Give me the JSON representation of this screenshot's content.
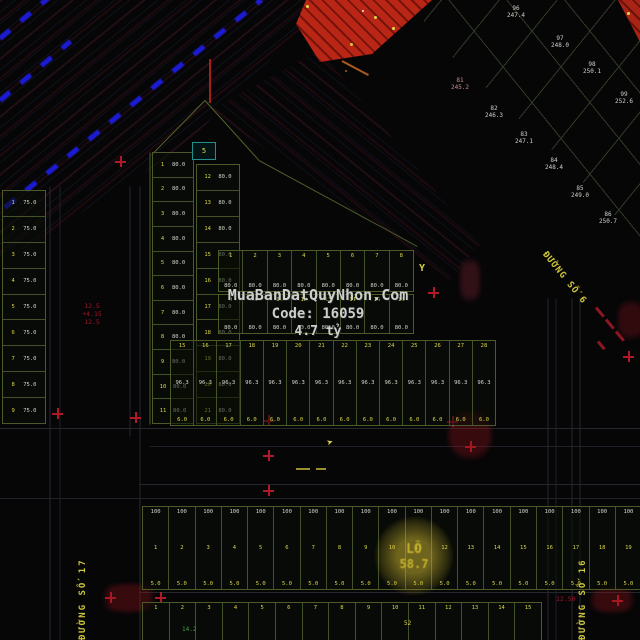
{
  "watermark": {
    "line1": "MuaBanDatQuyNhon.Com",
    "line2": "Code: 16059",
    "line3": "4.7 tỷ"
  },
  "streets": {
    "right_diagonal": "ĐƯỜNG SỐ 6",
    "left_vertical": "ĐƯỜNG SỐ 17",
    "right_vertical": "ĐƯỜNG SỐ 16"
  },
  "markers": {
    "y_mark": "Y",
    "plane_glyph": "➤",
    "stamp_line1": "LÔ",
    "stamp_line2": "58.7",
    "teal_box_label": "5",
    "road_annotation": [
      "12.5",
      "+4.15",
      "12.5"
    ],
    "south_road_annotation": "12.50",
    "bottom_green_note": "14.2",
    "bottom_yellow_note": "52"
  },
  "colors": {
    "background": "#060607",
    "blue_dash": "#1b1bd6",
    "red_fill": "#b92616",
    "parcel_border": "#4c5a28",
    "yellow_text": "#ddd74a",
    "white_text": "#d6d8ce",
    "red_annotation": "#a51628",
    "street_yellow": "#cfc53a"
  },
  "grid_labels": [
    {
      "x": 516,
      "y": 6,
      "l1": "96",
      "l2": "247.4",
      "pink": false
    },
    {
      "x": 560,
      "y": 36,
      "l1": "97",
      "l2": "248.0",
      "pink": false
    },
    {
      "x": 592,
      "y": 62,
      "l1": "98",
      "l2": "250.1",
      "pink": false
    },
    {
      "x": 624,
      "y": 92,
      "l1": "99",
      "l2": "252.6",
      "pink": false
    },
    {
      "x": 460,
      "y": 78,
      "l1": "81",
      "l2": "245.2",
      "pink": true
    },
    {
      "x": 494,
      "y": 106,
      "l1": "82",
      "l2": "246.3",
      "pink": false
    },
    {
      "x": 524,
      "y": 132,
      "l1": "83",
      "l2": "247.1",
      "pink": false
    },
    {
      "x": 554,
      "y": 158,
      "l1": "84",
      "l2": "248.4",
      "pink": false
    },
    {
      "x": 580,
      "y": 186,
      "l1": "85",
      "l2": "249.0",
      "pink": false
    },
    {
      "x": 608,
      "y": 212,
      "l1": "86",
      "l2": "250.7",
      "pink": false
    }
  ],
  "strips": [
    {
      "id": "left-strip",
      "x": 2,
      "y": 190,
      "w": 42,
      "h": 232,
      "dir": "rows",
      "slots": [
        "yl",
        "wh"
      ],
      "cells": [
        [
          "1",
          "75.0"
        ],
        [
          "2",
          "75.0"
        ],
        [
          "3",
          "75.0"
        ],
        [
          "4",
          "75.0"
        ],
        [
          "5",
          "75.0"
        ],
        [
          "6",
          "75.0"
        ],
        [
          "7",
          "75.0"
        ],
        [
          "8",
          "75.0"
        ],
        [
          "9",
          "75.0"
        ]
      ]
    },
    {
      "id": "col-a",
      "x": 152,
      "y": 152,
      "w": 40,
      "h": 270,
      "dir": "rows",
      "slots": [
        "yl",
        "wh"
      ],
      "cells": [
        [
          "1",
          "80.0"
        ],
        [
          "2",
          "80.0"
        ],
        [
          "3",
          "80.0"
        ],
        [
          "4",
          "80.0"
        ],
        [
          "5",
          "80.0"
        ],
        [
          "6",
          "80.0"
        ],
        [
          "7",
          "80.0"
        ],
        [
          "8",
          "80.0"
        ],
        [
          "9",
          "80.0"
        ],
        [
          "10",
          "80.0"
        ],
        [
          "11",
          "80.0"
        ]
      ]
    },
    {
      "id": "col-b",
      "x": 196,
      "y": 164,
      "w": 42,
      "h": 258,
      "dir": "rows",
      "slots": [
        "yl",
        "wh"
      ],
      "cells": [
        [
          "12",
          "80.0"
        ],
        [
          "13",
          "80.0"
        ],
        [
          "14",
          "80.0"
        ],
        [
          "15",
          "80.0"
        ],
        [
          "16",
          "80.0"
        ],
        [
          "17",
          "80.0"
        ],
        [
          "18",
          "80.0"
        ],
        [
          "19",
          "80.0"
        ],
        [
          "20",
          "80.0"
        ],
        [
          "21",
          "80.0"
        ]
      ]
    },
    {
      "id": "band-top",
      "x": 218,
      "y": 250,
      "w": 194,
      "h": 40,
      "dir": "cols",
      "slots": [
        "yl",
        "wh"
      ],
      "cells": [
        [
          "1",
          "80.0"
        ],
        [
          "2",
          "80.0"
        ],
        [
          "3",
          "80.0"
        ],
        [
          "4",
          "80.0"
        ],
        [
          "5",
          "80.0"
        ],
        [
          "6",
          "80.0"
        ],
        [
          "7",
          "80.0"
        ],
        [
          "8",
          "80.0"
        ]
      ]
    },
    {
      "id": "band-mid",
      "x": 218,
      "y": 294,
      "w": 194,
      "h": 38,
      "dir": "cols",
      "slots": [
        "yl",
        "wh"
      ],
      "cells": [
        [
          "9",
          "80.0"
        ],
        [
          "10",
          "80.0"
        ],
        [
          "11",
          "80.0"
        ],
        [
          "12",
          "80.0"
        ],
        [
          "13",
          "80.0"
        ],
        [
          "14",
          "80.0"
        ],
        [
          "15",
          "80.0"
        ],
        [
          "16",
          "80.0"
        ]
      ]
    },
    {
      "id": "band-bottom",
      "x": 170,
      "y": 340,
      "w": 324,
      "h": 84,
      "dir": "cols",
      "slots": [
        "yl",
        "wh",
        "yl"
      ],
      "cells": [
        [
          "15",
          "96.3",
          "6.0"
        ],
        [
          "16",
          "96.3",
          "6.0"
        ],
        [
          "17",
          "96.3",
          "6.0"
        ],
        [
          "18",
          "96.3",
          "6.0"
        ],
        [
          "19",
          "96.3",
          "6.0"
        ],
        [
          "20",
          "96.3",
          "6.0"
        ],
        [
          "21",
          "96.3",
          "6.0"
        ],
        [
          "22",
          "96.3",
          "6.0"
        ],
        [
          "23",
          "96.3",
          "6.0"
        ],
        [
          "24",
          "96.3",
          "6.0"
        ],
        [
          "25",
          "96.3",
          "6.0"
        ],
        [
          "26",
          "96.3",
          "6.0"
        ],
        [
          "27",
          "96.3",
          "6.0"
        ],
        [
          "28",
          "96.3",
          "6.0"
        ]
      ]
    },
    {
      "id": "strip-south",
      "x": 142,
      "y": 506,
      "w": 498,
      "h": 82,
      "dir": "cols",
      "slots": [
        "wh",
        "yl",
        "yl"
      ],
      "cells": [
        [
          "100",
          "1",
          "5.0"
        ],
        [
          "100",
          "2",
          "5.0"
        ],
        [
          "100",
          "3",
          "5.0"
        ],
        [
          "100",
          "4",
          "5.0"
        ],
        [
          "100",
          "5",
          "5.0"
        ],
        [
          "100",
          "6",
          "5.0"
        ],
        [
          "100",
          "7",
          "5.0"
        ],
        [
          "100",
          "8",
          "5.0"
        ],
        [
          "100",
          "9",
          "5.0"
        ],
        [
          "100",
          "10",
          "5.0"
        ],
        [
          "100",
          "11",
          "5.0"
        ],
        [
          "100",
          "12",
          "5.0"
        ],
        [
          "100",
          "13",
          "5.0"
        ],
        [
          "100",
          "14",
          "5.0"
        ],
        [
          "100",
          "15",
          "5.0"
        ],
        [
          "100",
          "16",
          "5.0"
        ],
        [
          "100",
          "17",
          "5.0"
        ],
        [
          "100",
          "18",
          "5.0"
        ],
        [
          "100",
          "19",
          "5.0"
        ]
      ]
    },
    {
      "id": "strip-south2",
      "x": 142,
      "y": 602,
      "w": 398,
      "h": 38,
      "dir": "cols",
      "slots": [
        "yl"
      ],
      "cells": [
        [
          "1"
        ],
        [
          "2"
        ],
        [
          "3"
        ],
        [
          "4"
        ],
        [
          "5"
        ],
        [
          "6"
        ],
        [
          "7"
        ],
        [
          "8"
        ],
        [
          "9"
        ],
        [
          "10"
        ],
        [
          "11"
        ],
        [
          "12"
        ],
        [
          "13"
        ],
        [
          "14"
        ],
        [
          "15"
        ]
      ]
    }
  ],
  "blue_dashes": [
    {
      "x": 5,
      "y": 205,
      "len": 330,
      "rot": -39
    },
    {
      "x": 0,
      "y": 98,
      "len": 92,
      "rot": -40
    },
    {
      "x": 0,
      "y": 36,
      "len": 64,
      "rot": -40
    }
  ],
  "lines": [
    {
      "x": 205,
      "y": 100,
      "len": 76,
      "rot": 134.5,
      "c": "#566628",
      "t": 1
    },
    {
      "x": 205,
      "y": 100,
      "len": 81,
      "rot": 48,
      "c": "#566628",
      "t": 1
    },
    {
      "x": 259,
      "y": 160,
      "len": 180,
      "rot": 28.5,
      "c": "#4c5a26",
      "t": 1
    },
    {
      "x": 150,
      "y": 152,
      "len": 272,
      "rot": 90,
      "c": "#4f5e2a",
      "t": 1
    },
    {
      "x": 0,
      "y": 428,
      "len": 640,
      "rot": 0,
      "c": "#26262e",
      "t": 1
    },
    {
      "x": 150,
      "y": 446,
      "len": 490,
      "rot": 0,
      "c": "#21212a",
      "t": 1
    },
    {
      "x": 140,
      "y": 484,
      "len": 500,
      "rot": 0,
      "c": "#26262e",
      "t": 1
    },
    {
      "x": 0,
      "y": 498,
      "len": 640,
      "rot": 0,
      "c": "#21212a",
      "t": 1
    },
    {
      "x": 140,
      "y": 592,
      "len": 500,
      "rot": 0,
      "c": "#26262e",
      "t": 1
    },
    {
      "x": 50,
      "y": 186,
      "len": 454,
      "rot": 90,
      "c": "#262630",
      "t": 1
    },
    {
      "x": 60,
      "y": 186,
      "len": 454,
      "rot": 90,
      "c": "#1f1f28",
      "t": 1
    },
    {
      "x": 130,
      "y": 186,
      "len": 250,
      "rot": 90,
      "c": "#262630",
      "t": 1
    },
    {
      "x": 140,
      "y": 186,
      "len": 454,
      "rot": 90,
      "c": "#262630",
      "t": 1
    },
    {
      "x": 548,
      "y": 298,
      "len": 342,
      "rot": 90,
      "c": "#262630",
      "t": 1
    },
    {
      "x": 556,
      "y": 298,
      "len": 342,
      "rot": 90,
      "c": "#1f1f28",
      "t": 1
    },
    {
      "x": 572,
      "y": 298,
      "len": 342,
      "rot": 90,
      "c": "#262630",
      "t": 1
    },
    {
      "x": 580,
      "y": 298,
      "len": 342,
      "rot": 90,
      "c": "#262630",
      "t": 1
    },
    {
      "x": 296,
      "y": 468,
      "len": 14,
      "rot": 0,
      "c": "#9a8f2e",
      "t": 2
    },
    {
      "x": 316,
      "y": 468,
      "len": 10,
      "rot": 0,
      "c": "#9a8f2e",
      "t": 2
    },
    {
      "x": 210,
      "y": 58,
      "len": 44,
      "rot": 90,
      "c": "#a32015",
      "t": 2
    },
    {
      "x": 342,
      "y": 60,
      "len": 30,
      "rot": 28,
      "c": "#a85a20",
      "t": 2
    },
    {
      "x": 596,
      "y": 306,
      "len": 12,
      "rot": 50,
      "c": "#8c1622",
      "t": 3
    },
    {
      "x": 606,
      "y": 318,
      "len": 12,
      "rot": 50,
      "c": "#8c1622",
      "t": 3
    },
    {
      "x": 616,
      "y": 330,
      "len": 12,
      "rot": 50,
      "c": "#8c1622",
      "t": 3
    },
    {
      "x": 598,
      "y": 340,
      "len": 10,
      "rot": 50,
      "c": "#8c1622",
      "t": 3
    }
  ],
  "crosses": [
    {
      "x": 433,
      "y": 292
    },
    {
      "x": 268,
      "y": 420
    },
    {
      "x": 268,
      "y": 455
    },
    {
      "x": 268,
      "y": 490
    },
    {
      "x": 120,
      "y": 161
    },
    {
      "x": 57,
      "y": 413
    },
    {
      "x": 135,
      "y": 417
    },
    {
      "x": 160,
      "y": 597
    },
    {
      "x": 110,
      "y": 597
    },
    {
      "x": 617,
      "y": 600
    },
    {
      "x": 628,
      "y": 356
    },
    {
      "x": 452,
      "y": 421
    },
    {
      "x": 470,
      "y": 446
    }
  ],
  "blobs": [
    {
      "x": 448,
      "y": 408,
      "w": 44,
      "h": 54,
      "c": "rgba(150,20,30,.35)"
    },
    {
      "x": 96,
      "y": 584,
      "w": 66,
      "h": 28,
      "c": "rgba(150,20,30,.35)"
    },
    {
      "x": 584,
      "y": 588,
      "w": 56,
      "h": 24,
      "c": "rgba(150,20,30,.35)"
    },
    {
      "x": 618,
      "y": 296,
      "w": 26,
      "h": 48,
      "c": "rgba(150,20,30,.30)"
    },
    {
      "x": 460,
      "y": 252,
      "w": 20,
      "h": 56,
      "c": "rgba(150,40,60,.30)"
    }
  ],
  "dots": [
    {
      "x": 362,
      "y": 10,
      "s": 2,
      "c": "#e8e8e0"
    },
    {
      "x": 374,
      "y": 16,
      "s": 3,
      "c": "#e0d84a"
    },
    {
      "x": 392,
      "y": 27,
      "s": 3,
      "c": "#e0d84a"
    },
    {
      "x": 350,
      "y": 43,
      "s": 3,
      "c": "#d8cc3a"
    },
    {
      "x": 306,
      "y": 5,
      "s": 3,
      "c": "#e0d84a"
    },
    {
      "x": 627,
      "y": 12,
      "s": 3,
      "c": "#e0d84a"
    },
    {
      "x": 345,
      "y": 70,
      "s": 2,
      "c": "#b06020"
    }
  ]
}
